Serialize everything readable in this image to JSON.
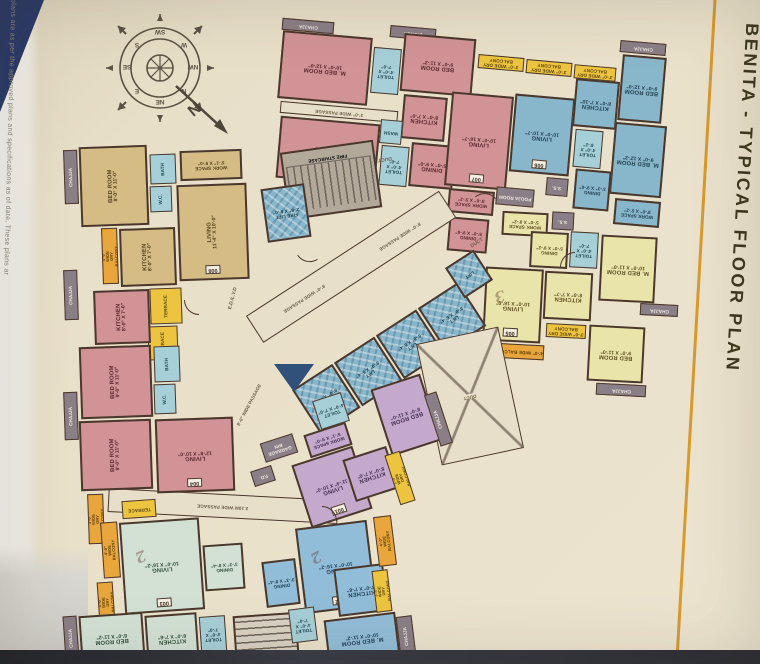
{
  "title": "BENITA - TYPICAL FLOOR PLAN",
  "disclaimer": "r plans are as per the approved plans and specifications as of date. These plans ar",
  "compass": {
    "n": "N",
    "ne": "NE",
    "e": "E",
    "se": "SE",
    "s": "S",
    "sw": "SW",
    "w": "W",
    "nw": "NW",
    "north_arrow": "N"
  },
  "core": {
    "fire_staircase": "FIRE STAIRCASE",
    "fire_lift_name": "FIRE LIFT",
    "fire_lift_dims": "2'-6\" X 8'-0\"",
    "lift_name": "LIFT",
    "lift_dims": "8'-0\" X 5'-4\"",
    "passage_8": "8'-0\" WIDE PASSAGE",
    "passage_3": "3'-0\" WIDE PASSAGE",
    "passage_210": "2.10M WIDE PASSAGE",
    "duct": "DUCT",
    "garbage_bin": "GARBAGE BIN",
    "fd": "F.D.",
    "ed_lvd": "E.D./L.V.D",
    "ss": "S.S.",
    "wash": "WASH",
    "pooja_room": "POOJA ROOM"
  },
  "labels": {
    "chajja": "CHAJJA",
    "dry_balcony_3": "3'-0\" WIDE DRY BALCONY",
    "dry_balcony_4": "4'-0\" WIDE DRY BALCONY",
    "balcony_4": "4'-0\" WIDE BALCONY",
    "terrace": "TERRACE"
  },
  "units": {
    "u001": {
      "number": "001",
      "living_name": "LIVING",
      "living_dims": "11'-4\" X 10'-0\"",
      "kitchen_name": "KITCHEN",
      "kitchen_dims": "8'-0\" X 7'-0\"",
      "bed_name": "BED ROOM",
      "bed_dims": "8'-0\" X 11'-0\"",
      "work_name": "WORK SPACE",
      "work_dims": "5'-1\" X 9'-0\"",
      "toilet_name": "TOILET",
      "toilet_dims": "4'-0\" X 7'-0\""
    },
    "u002": {
      "number": "002",
      "numeral": "2",
      "living_name": "LIVING",
      "living_dims": "10'-0\" X 16'-2\"",
      "dining_name": "DINING",
      "dining_dims": "3'-3\" X 8'-4\"",
      "kitchen_name": "KITCHEN",
      "kitchen_dims": "8'-0\" X 7'-6\"",
      "mbed_name": "M. BED ROOM",
      "mbed_dims": "10'-0\" X 11'-2\"",
      "toilet_name": "TOILET",
      "toilet_dims": "4'-0\" X 7'-0\""
    },
    "u003": {
      "number": "003",
      "numeral": "2",
      "living_name": "LIVING",
      "living_dims": "10'-0\" X 16'-2\"",
      "dining_name": "DINING",
      "dining_dims": "3'-3\" X 8'-4\"",
      "kitchen_name": "KITCHEN",
      "kitchen_dims": "8'-0\" X 7'-6\"",
      "bed_name": "BED ROOM",
      "bed_dims": "8'-0\" X 11'-2\"",
      "toilet_name": "TOILET",
      "toilet_dims": "4'-0\" X 7'-0\""
    },
    "u004": {
      "number": "004",
      "living_name": "LIVING",
      "living_dims": "12'-8\" X 10'-0\"",
      "kitchen_name": "KITCHEN",
      "kitchen_dims": "8'-0\" X 7'-0\"",
      "bed1_name": "BED ROOM",
      "bed1_dims": "9'-0\" X 11'-0\"",
      "bed2_name": "BED ROOM",
      "bed2_dims": "9'-0\" X 11'-0\"",
      "bath": "BATH",
      "wc": "W.C."
    },
    "u005": {
      "number": "005",
      "numeral": "3",
      "living_name": "LIVING",
      "living_dims": "10'-0\" X 16'-0\"",
      "dining_name": "DINING",
      "dining_dims": "5'-0\" X 9'-2\"",
      "work_name": "WORK SPACE",
      "work_dims": "5'-0\" X 9'-2\"",
      "kitchen_name": "KITCHEN",
      "kitchen_dims": "8'-0\" X 7'-7\"",
      "bed_name": "BED ROOM",
      "bed_dims": "9'-0\" X 11'-0\"",
      "mbed_name": "M. BED ROOM",
      "mbed_dims": "10'-0\" X 11'-0\"",
      "toilet_name": "TOILET",
      "toilet_dims": "4'-0\" X 7'-0\""
    },
    "u006": {
      "number": "006",
      "living_name": "LIVING",
      "living_dims": "10'-0\" X 10'-7\"",
      "dining_name": "DINING",
      "dining_dims": "3'-3\" X 9'-6\"",
      "work_name": "WORK SPACE",
      "work_dims": "8'-0\" X 5'-2\"",
      "kitchen_name": "KITCHEN",
      "kitchen_dims": "8'-0\" X 7'-10\"",
      "bed_name": "BED ROOM",
      "bed_dims": "9'-0\" X 12'-0\"",
      "mbed_name": "M. BED ROOM",
      "mbed_dims": "9'-0\" X 12'-2\"",
      "toilet_name": "TOILET",
      "toilet_dims": "4'-0\" X 6'-2\""
    },
    "u007": {
      "number": "007",
      "living_name": "LIVING",
      "living_dims": "10'-0\" X 16'-7\"",
      "dining_name": "DINING",
      "dining_dims": "5'-0\" X 9'-6\"",
      "dining2_name": "DINING",
      "dining2_dims": "5'-0\" X 9'-0\"",
      "kitchen_name": "KITCHEN",
      "kitchen_dims": "8'-0\" X 7'-0\"",
      "work_name": "WORK SPACE",
      "work_dims": "8'-0\" X 5'-2\"",
      "mbed1_name": "M. BED ROOM",
      "mbed1_dims": "10'-0\" X 12'-0\"",
      "bed_name": "BED ROOM",
      "bed_dims": "9'-0\" X 11'-2\"",
      "mbed2_name": "M. BED ROOM",
      "mbed2_dims": "12'-0\" X 9'-0\"",
      "toilet_name": "TOILET",
      "toilet_dims": "4'-0\" X 7'-0\""
    },
    "u008": {
      "number": "008",
      "living_name": "LIVING",
      "living_dims": "11'-4\" X 10'-0\"",
      "kitchen_name": "KITCHEN",
      "kitchen_dims": "8'-0\" X 7'-0\"",
      "bed_name": "BED ROOM",
      "bed_dims": "8'-0\" X 11'-0\"",
      "work_name": "WORK SPACE",
      "work_dims": "5'-1\" X 9'-0\"",
      "bath": "BATH",
      "wc": "W.C."
    }
  }
}
